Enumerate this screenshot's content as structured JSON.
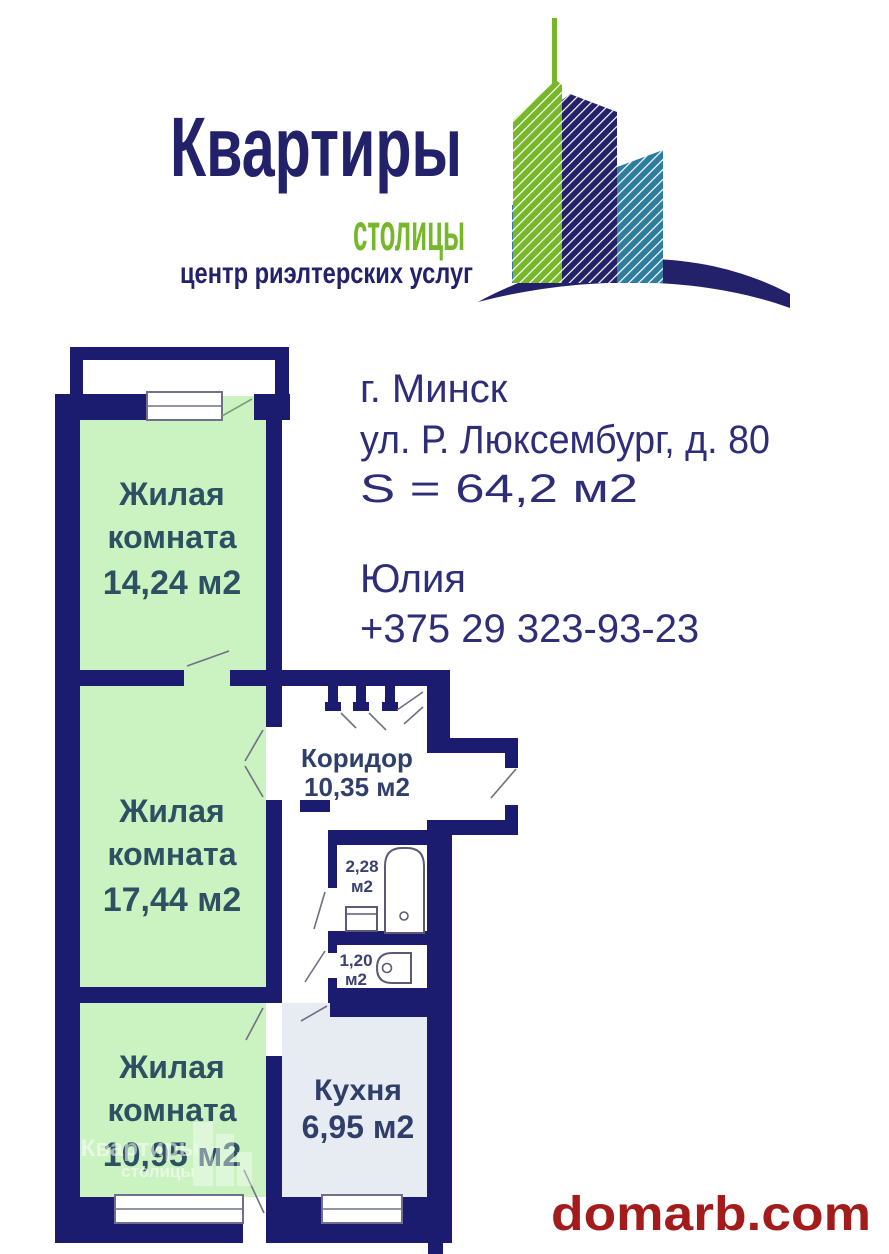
{
  "brand": {
    "title": "Квартиры",
    "subtitle": "столицы",
    "tagline": "центр риэлтерских услуг"
  },
  "listing": {
    "city": "г. Минск",
    "address": "ул. Р. Люксембург, д. 80",
    "total_area": "S = 64,2  м2",
    "contact_name": "Юлия",
    "contact_phone": "+375 29 323-93-23"
  },
  "floorplan": {
    "room1": {
      "name_line1": "Жилая",
      "name_line2": "комната",
      "area": "14,24 м2"
    },
    "room2": {
      "name_line1": "Жилая",
      "name_line2": "комната",
      "area": "17,44 м2"
    },
    "room3": {
      "name_line1": "Жилая",
      "name_line2": "комната",
      "area": "10,95 м2"
    },
    "corridor": {
      "name": "Коридор",
      "area": "10,35 м2"
    },
    "kitchen": {
      "name": "Кухня",
      "area": "6,95 м2"
    },
    "bathroom": {
      "area_value": "2,28",
      "area_unit": "м2"
    },
    "toilet": {
      "area_value": "1,20",
      "area_unit": "м2"
    }
  },
  "watermark": {
    "site": "domarb.com"
  },
  "colors": {
    "wall": "#1b1b70",
    "room_fill": "#cbf2c1",
    "kitchen_fill": "#e7ebf2",
    "brand_navy": "#232169",
    "brand_green": "#76b82a",
    "brand_teal": "#2e7d9e",
    "text_navy": "#2e2e78",
    "room_label": "#2d5163",
    "hall_label": "#2f3f6a",
    "site_red": "#a31b1b",
    "line": "#6f6f85"
  }
}
